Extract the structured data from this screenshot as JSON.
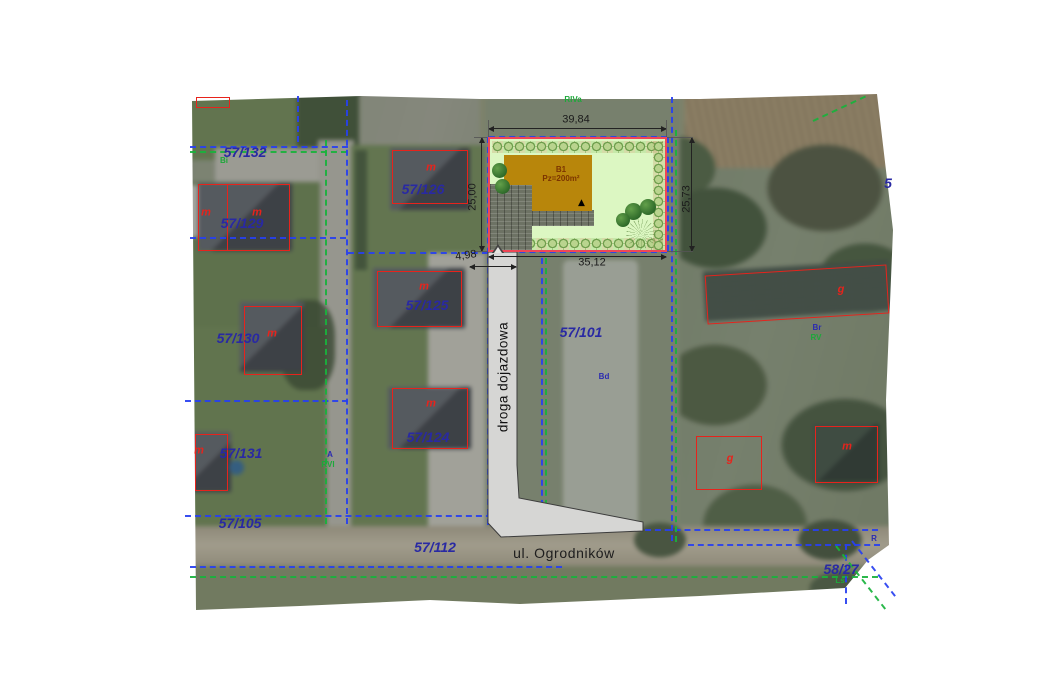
{
  "map": {
    "kind": "cadastral-site-plan-over-aerial-photo",
    "streets": {
      "main": "ul. Ogrodników",
      "access": "droga dojazdowa"
    },
    "design": {
      "building_id": "B1",
      "building_area": "Pz=200m²"
    },
    "dimensions": [
      {
        "text": "39,84",
        "x": 576,
        "y": 120,
        "rot": 0
      },
      {
        "text": "25,00",
        "x": 473,
        "y": 197,
        "rot": -90
      },
      {
        "text": "25,73",
        "x": 687,
        "y": 199,
        "rot": -90
      },
      {
        "text": "35,12",
        "x": 592,
        "y": 263,
        "rot": 0
      },
      {
        "text": "4,98",
        "x": 466,
        "y": 256,
        "rot": -8
      }
    ],
    "parcel_numbers": [
      {
        "text": "57/132",
        "x": 245,
        "y": 152
      },
      {
        "text": "57/126",
        "x": 423,
        "y": 189
      },
      {
        "text": "57/129",
        "x": 242,
        "y": 223
      },
      {
        "text": "57/125",
        "x": 427,
        "y": 305
      },
      {
        "text": "57/130",
        "x": 238,
        "y": 338
      },
      {
        "text": "57/124",
        "x": 428,
        "y": 437
      },
      {
        "text": "57/131",
        "x": 241,
        "y": 453
      },
      {
        "text": "57/105",
        "x": 240,
        "y": 523
      },
      {
        "text": "57/112",
        "x": 435,
        "y": 547
      },
      {
        "text": "57/101",
        "x": 581,
        "y": 332
      },
      {
        "text": "58/27",
        "x": 841,
        "y": 569
      },
      {
        "text": "5",
        "x": 888,
        "y": 183
      }
    ],
    "building_letters": [
      {
        "text": "m",
        "x": 206,
        "y": 213
      },
      {
        "text": "m",
        "x": 257,
        "y": 213
      },
      {
        "text": "m",
        "x": 431,
        "y": 168
      },
      {
        "text": "m",
        "x": 424,
        "y": 287
      },
      {
        "text": "m",
        "x": 272,
        "y": 334
      },
      {
        "text": "m",
        "x": 431,
        "y": 404
      },
      {
        "text": "m",
        "x": 199,
        "y": 451
      },
      {
        "text": "g",
        "x": 841,
        "y": 290
      },
      {
        "text": "g",
        "x": 730,
        "y": 459
      },
      {
        "text": "m",
        "x": 847,
        "y": 447
      }
    ],
    "landuse_labels": [
      {
        "text": "RIVa",
        "x": 573,
        "y": 100,
        "color": "green-t"
      },
      {
        "text": "Bi",
        "x": 224,
        "y": 161,
        "color": "green-t"
      },
      {
        "text": "Bd",
        "x": 604,
        "y": 377,
        "color": "blue-t"
      },
      {
        "text": "Br",
        "x": 817,
        "y": 328,
        "color": "blue-t"
      },
      {
        "text": "RV",
        "x": 816,
        "y": 338,
        "color": "green-t"
      },
      {
        "text": "A",
        "x": 330,
        "y": 455,
        "color": "blue-t"
      },
      {
        "text": "RVI",
        "x": 328,
        "y": 465,
        "color": "green-t"
      },
      {
        "text": "R",
        "x": 874,
        "y": 539,
        "color": "blue-t"
      },
      {
        "text": "Ls",
        "x": 840,
        "y": 581,
        "color": "green-t"
      }
    ],
    "colors": {
      "parcel_label": "#2929a3",
      "building_outline_red": "#e7231c",
      "boundary_blue": "#2840f0",
      "boundary_green": "#18b33c",
      "plot_border": "#ef4655",
      "plot_fill": "#dcf7c2",
      "building_fill": "#b8860b",
      "access_road_fill": "#d6d6d4",
      "dimension_text": "#1b1b1b",
      "landuse_green": "#1da83a",
      "landuse_blue": "#2b2bb0"
    }
  }
}
